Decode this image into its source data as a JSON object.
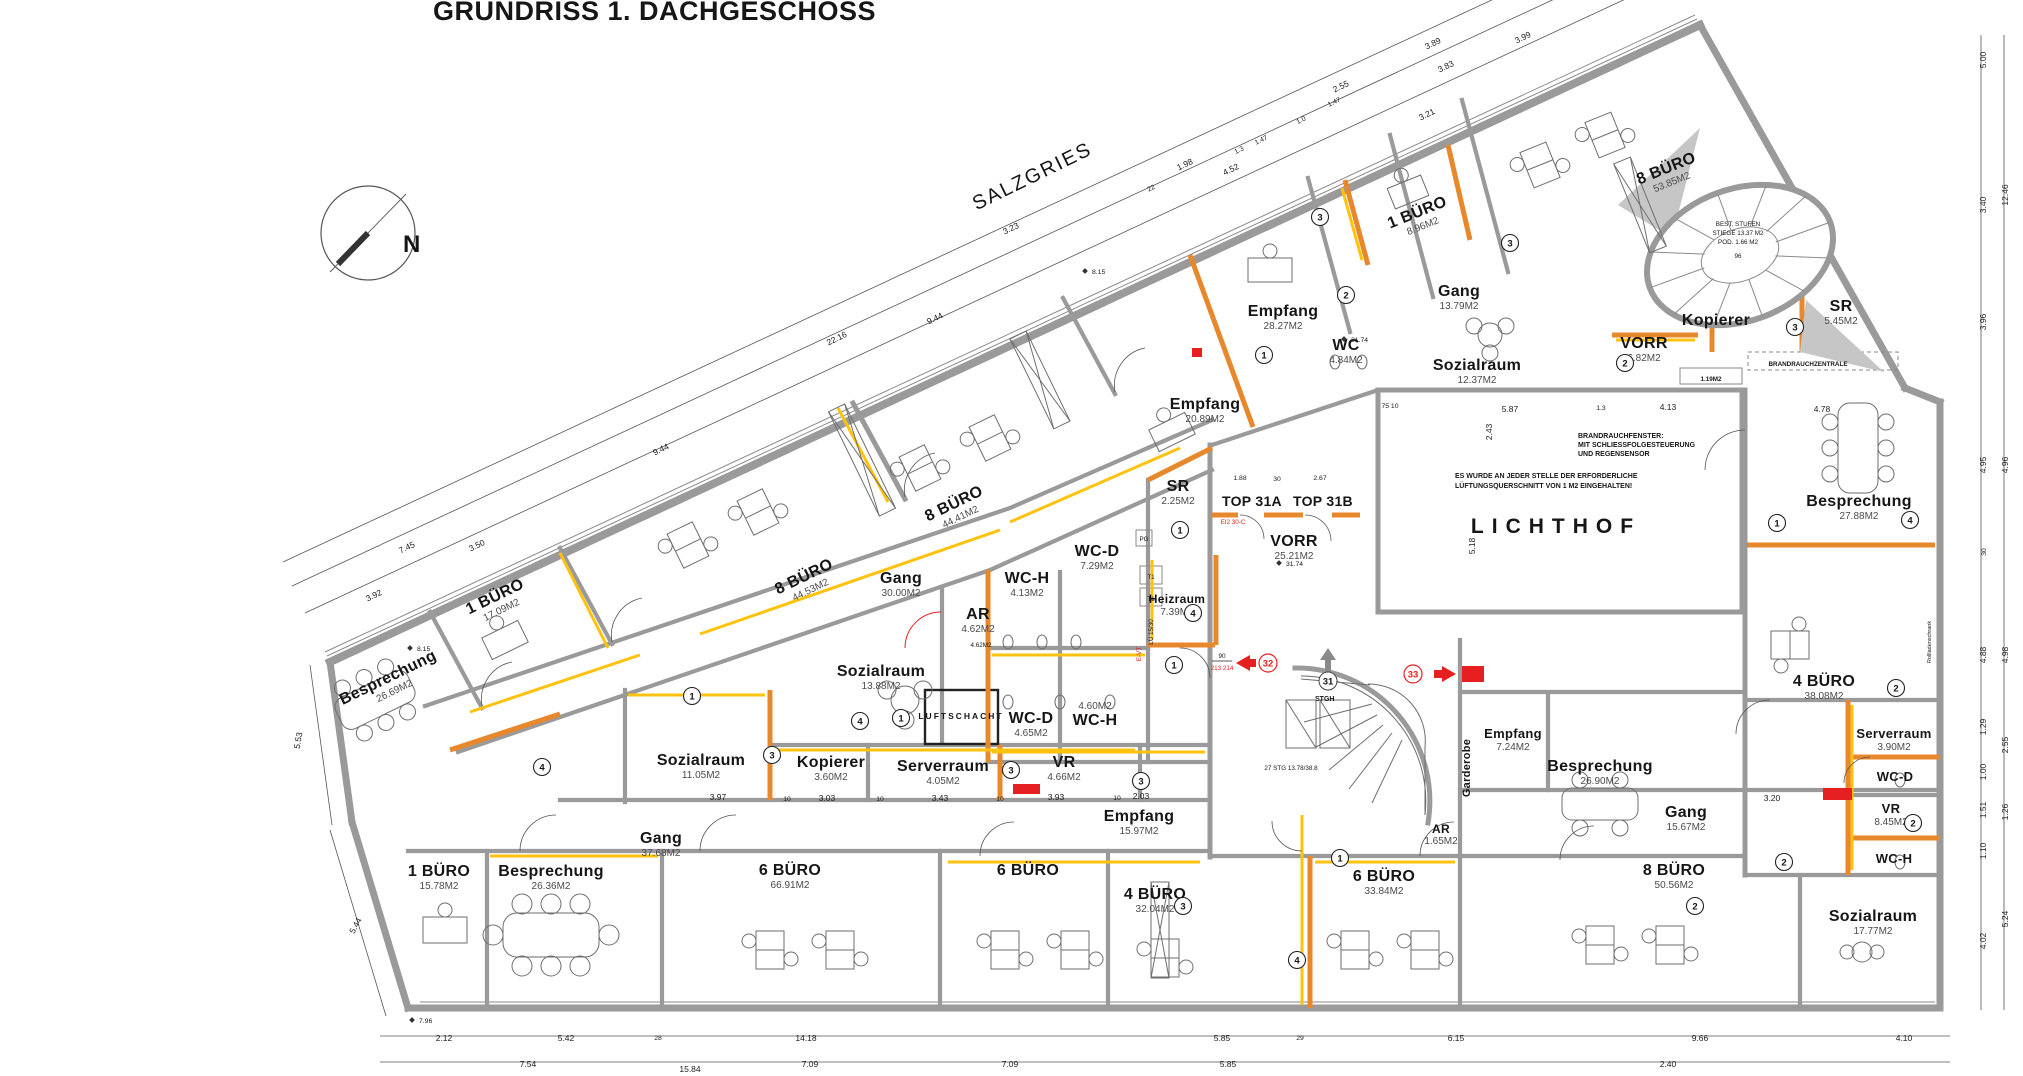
{
  "title": "GRUNDRISS 1. DACHGESCHOSS",
  "street": "SALZGRIES",
  "compass_label": "N",
  "colors": {
    "wall_gray": "#9a9a9a",
    "accent_orange": "#e8882c",
    "accent_yellow": "#ffc20e",
    "alert_red": "#e62020"
  },
  "rooms": [
    {
      "n": "Besprechung",
      "a": "26.69M2"
    },
    {
      "n": "1 BÜRO",
      "a": "17.09M2"
    },
    {
      "n": "8 BÜRO",
      "a": "44.53M2"
    },
    {
      "n": "8 BÜRO",
      "a": "44.41M2"
    },
    {
      "n": "Empfang",
      "a": "20.89M2"
    },
    {
      "n": "Empfang",
      "a": "28.27M2"
    },
    {
      "n": "WC",
      "a": "4.84M2"
    },
    {
      "n": "1 BÜRO",
      "a": "8.96M2"
    },
    {
      "n": "Gang",
      "a": "13.79M2"
    },
    {
      "n": "Sozialraum",
      "a": "12.37M2"
    },
    {
      "n": "VORR",
      "a": "6.82M2"
    },
    {
      "n": "Kopierer",
      "a": ""
    },
    {
      "n": "8 BÜRO",
      "a": "53.85M2"
    },
    {
      "n": "SR",
      "a": "5.45M2"
    },
    {
      "n": "Gang",
      "a": "30.00M2"
    },
    {
      "n": "SR",
      "a": "2.25M2"
    },
    {
      "n": "VORR",
      "a": "25.21M2"
    },
    {
      "n": "WC-H",
      "a": "4.13M2"
    },
    {
      "n": "WC-D",
      "a": "7.29M2"
    },
    {
      "n": "Heizraum",
      "a": "7.39M2"
    },
    {
      "n": "AR",
      "a": "4.62M2"
    },
    {
      "n": "Sozialraum",
      "a": "13.88M2"
    },
    {
      "n": "WC-D",
      "a": "4.65M2"
    },
    {
      "n": "WC-H",
      "a": "4.60M2"
    },
    {
      "n": "Kopierer",
      "a": "3.60M2"
    },
    {
      "n": "Serverraum",
      "a": "4.05M2"
    },
    {
      "n": "VR",
      "a": "4.66M2"
    },
    {
      "n": "Sozialraum",
      "a": "11.05M2"
    },
    {
      "n": "Gang",
      "a": "37.68M2"
    },
    {
      "n": "Empfang",
      "a": "15.97M2"
    },
    {
      "n": "Garderobe",
      "a": ""
    },
    {
      "n": "Empfang",
      "a": "7.24M2"
    },
    {
      "n": "AR",
      "a": "1.65M2"
    },
    {
      "n": "Besprechung",
      "a": "26.90M2"
    },
    {
      "n": "Gang",
      "a": "15.67M2"
    },
    {
      "n": "Besprechung",
      "a": "27.88M2"
    },
    {
      "n": "4 BÜRO",
      "a": "38.08M2"
    },
    {
      "n": "Serverraum",
      "a": "3.90M2"
    },
    {
      "n": "WC-D",
      "a": ""
    },
    {
      "n": "VR",
      "a": "8.45M2"
    },
    {
      "n": "WC-H",
      "a": ""
    },
    {
      "n": "Sozialraum",
      "a": "17.77M2"
    },
    {
      "n": "1 BÜRO",
      "a": "15.78M2"
    },
    {
      "n": "Besprechung",
      "a": "26.36M2"
    },
    {
      "n": "6 BÜRO",
      "a": "66.91M2"
    },
    {
      "n": "6 BÜRO",
      "a": ""
    },
    {
      "n": "4 BÜRO",
      "a": "32.04M2"
    },
    {
      "n": "6 BÜRO",
      "a": "33.84M2"
    },
    {
      "n": "8 BÜRO",
      "a": "50.56M2"
    }
  ],
  "labels": {
    "lichthof": "LICHTHOF",
    "luftschacht": "LUFTSCHACHT",
    "top31a": "TOP 31A",
    "top31b": "TOP 31B",
    "stgh": "STGH",
    "stg27": "27 STG  13.78/38.8",
    "stair_l1": "BEST. STUFEN",
    "stair_l2": "STIEGE 13.37 M2",
    "stair_l3": "POD. 1.66 M2",
    "stair_l4": "96",
    "brz": "BRANDRAUCHZENTRALE",
    "m119": "1.19M2",
    "ar_sub": "4.62M2",
    "note1_l1": "BRANDRAUCHFENSTER:",
    "note1_l2": "MIT SCHLIESSFOLGESTEUERUNG",
    "note1_l3": "UND REGENSENSOR",
    "note2_l1": "ES WURDE AN JEDER STELLE DER ERFORDERLICHE",
    "note2_l2": "LÜFTUNGSQUERSCHNITT VON 1 M2 EINGEHALTEN!",
    "lo1530": "LÜ 15/30",
    "t1": "T1",
    "pg": "PG",
    "rollschrank": "Rollladenschrank",
    "ei30": "EI2 30-C",
    "evt": "E-VT",
    "d90": "90",
    "d213": "213 214"
  },
  "window_tags": [
    "3",
    "2",
    "1",
    "3",
    "2",
    "3",
    "1",
    "4",
    "1",
    "3",
    "3",
    "4",
    "1",
    "3",
    "1",
    "4",
    "2",
    "2",
    "2",
    "1",
    "4",
    "1",
    "4",
    "3",
    "2"
  ],
  "exit_tags": {
    "e31": "31",
    "e32": "32",
    "e33": "33"
  },
  "dims": {
    "top": [
      "22.16",
      "9.44",
      "9.44",
      "3.23",
      "1.98",
      "4.52",
      "2.55",
      "3.21",
      "3.83",
      "3.89",
      "3.99",
      "1.47",
      "1.0",
      "1.47",
      "1.3",
      "22",
      "7.45",
      "3.50",
      "3.92"
    ],
    "left": [
      "5.53",
      "5.44"
    ],
    "right": [
      "5.00",
      "12.46",
      "3.40",
      "3.96",
      "4.95",
      "4.96",
      "30",
      "4.88",
      "4.98",
      "1.29",
      "2.55",
      "1.00",
      "1.51",
      "1.26",
      "1.10",
      "4.02",
      "5.24"
    ],
    "bottom1": [
      "2.12",
      "5.42",
      "28",
      "14.18",
      "5.85",
      "29",
      "6.15",
      "9.66",
      "4.10"
    ],
    "bottom2": [
      "7.54",
      "15.84",
      "7.09",
      "7.09",
      "5.85",
      "2.40"
    ],
    "interior": [
      "5.87",
      "1.3",
      "4.13",
      "4.78",
      "2.43",
      "5.18",
      "75  10",
      "1.88",
      "30",
      "2.67",
      "3.97",
      "10",
      "3.03",
      "10",
      "3.43",
      "10",
      "3.93",
      "10",
      "2.03",
      "3.20"
    ],
    "markers": [
      "8.15",
      "8.15",
      "31.74",
      "31.74",
      "7.96"
    ]
  }
}
